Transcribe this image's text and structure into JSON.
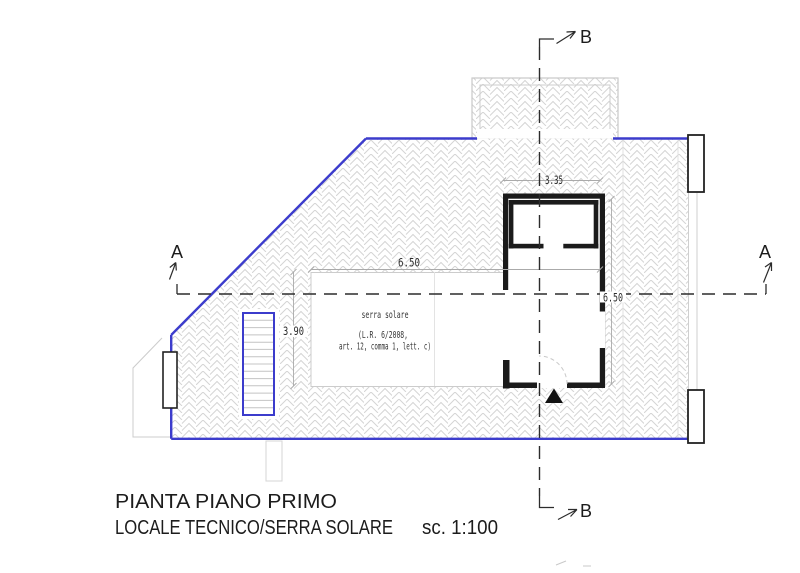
{
  "drawing": {
    "title_line1": "PIANTA PIANO PRIMO",
    "title_line2": "LOCALE TECNICO/SERRA SOLARE",
    "scale_label": "sc. 1:100"
  },
  "section_markers": {
    "a": "A",
    "b": "B"
  },
  "dimensions": {
    "top_room_width": "3.35",
    "serra_width": "6.50",
    "stair_depth": "3.90",
    "room_depth": "6.50"
  },
  "annotations": {
    "serra_line1": "serra solare",
    "serra_line2": "(L.R.  6/2008,",
    "serra_line3": "art. 12, comma 1, lett. c)"
  },
  "colors": {
    "plan_outline_blue": "#3c3ccc",
    "wall_black": "#1b1b1b",
    "hatch_gray": "#d4d4d4",
    "section_line": "#2c2c2c"
  }
}
